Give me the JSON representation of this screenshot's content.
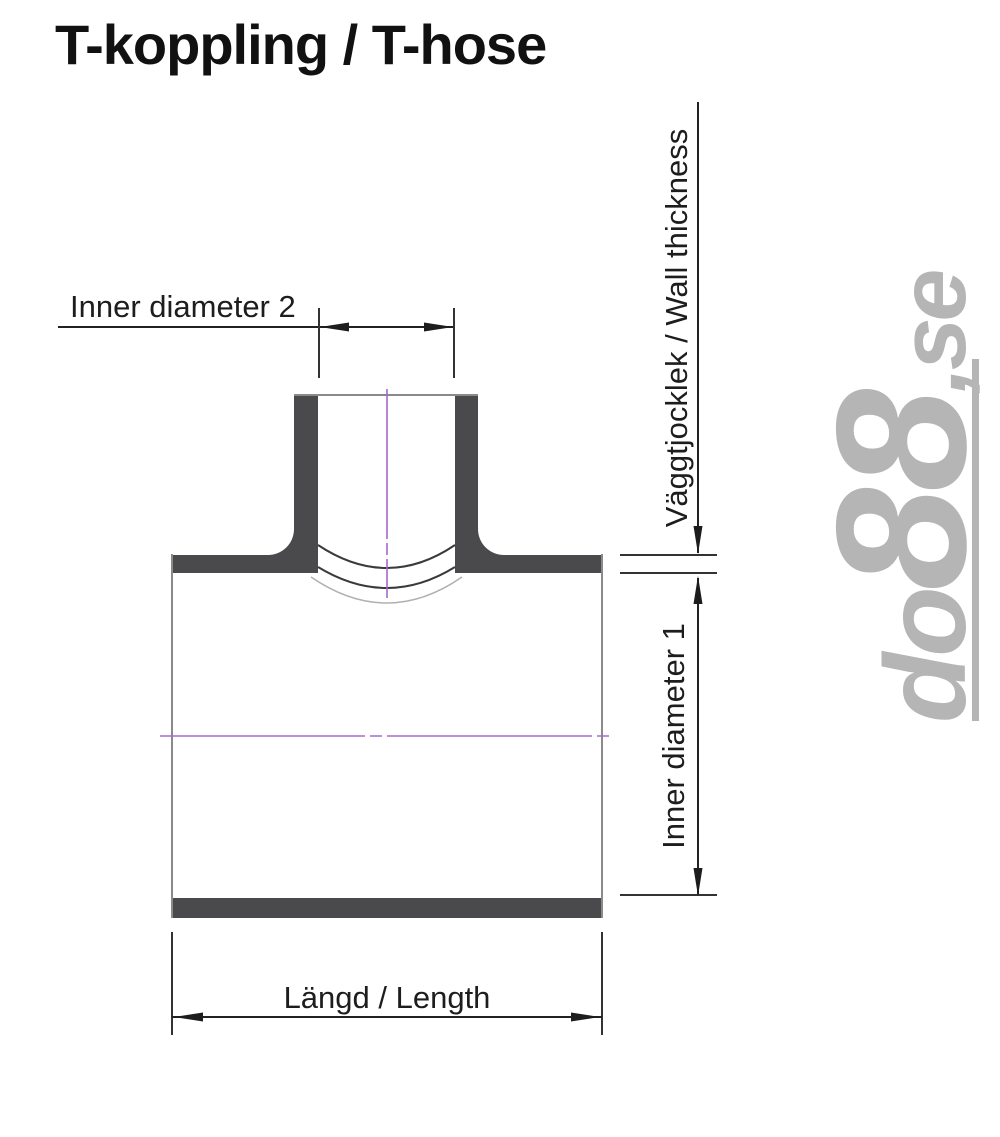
{
  "title": "T-koppling / T-hose",
  "diagram": {
    "labels": {
      "inner_diameter_2": "Inner diameter 2",
      "wall_thickness": "Väggtjocklek / Wall thickness",
      "inner_diameter_1": "Inner diameter 1",
      "length": "Längd / Length"
    },
    "colors": {
      "wall_fill": "#4a4a4c",
      "outline": "#8a8a8a",
      "dimension": "#222222",
      "centerline": "#a668cf",
      "watermark": "#b5b5b5"
    }
  },
  "watermark": {
    "full_text": "do88.se",
    "parts": {
      "do": "do",
      "eights": "88",
      "se": ",se"
    }
  }
}
